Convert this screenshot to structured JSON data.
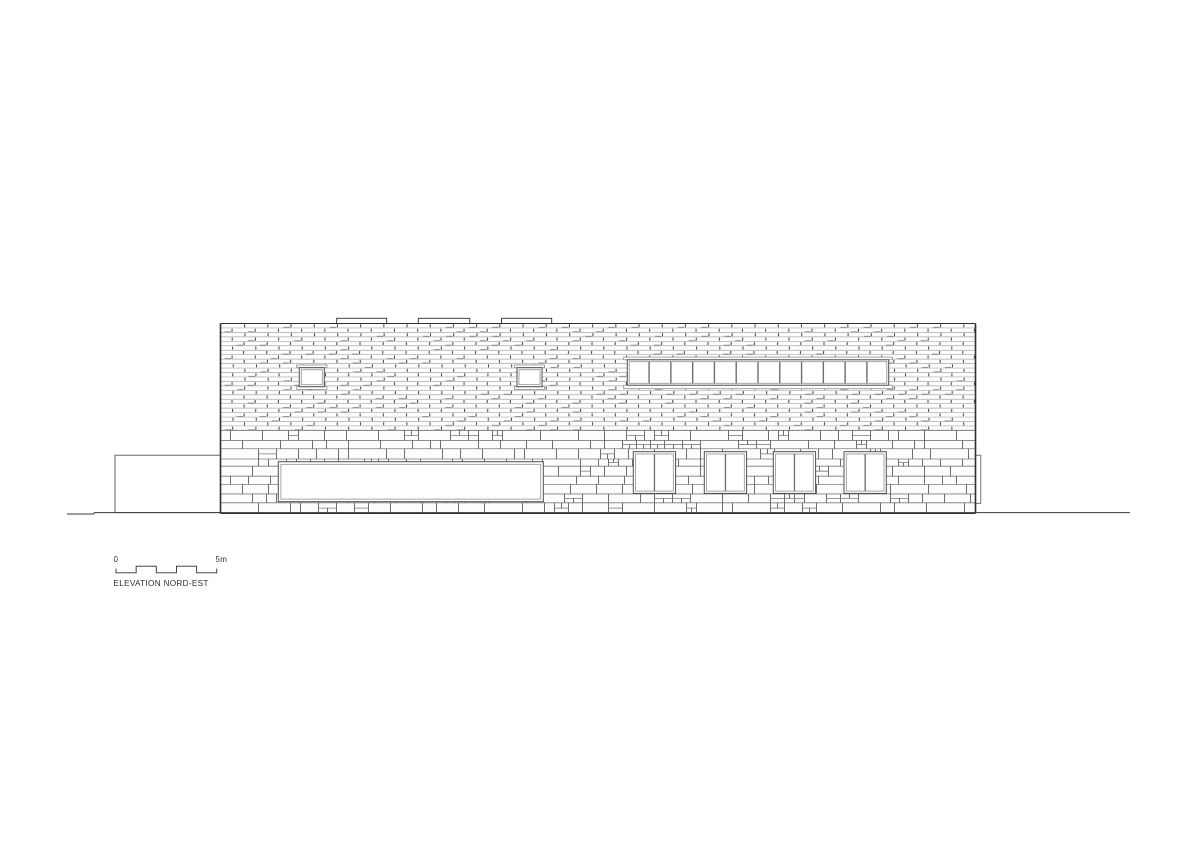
{
  "title": "ELEVATION NORD-EST",
  "scale_bar": {
    "start_label": "0",
    "end_label": "5m",
    "x": 116.0,
    "y_top": 566.2,
    "y_bottom": 572.8,
    "segment_w": 20.15,
    "segments": 5,
    "end_tick_y": 568.6
  },
  "drawing": {
    "canvas": {
      "w": 1200,
      "h": 848
    },
    "colors": {
      "outline": "#2f2f2f",
      "frame": "#4f4f4f",
      "frame_inner": "#909090",
      "mullion": "#6e6e6e",
      "brick_line": "#a9a9a9",
      "brick_tick": "#4d4d4d",
      "brick_accent": "#8a8a8a",
      "ashlar_line": "#7d7d7d",
      "ashlar_joint": "#5f5f5f",
      "band_stroke": "#8f8f8f",
      "facade_fill": "#fdfdfd",
      "white": "#ffffff",
      "ground": "#3a3a3a"
    },
    "building": {
      "x1": 220.5,
      "y1": 323.5,
      "x2": 975.5,
      "y2": 513.4
    },
    "brick": {
      "y_bottom": 430.4,
      "row_h": 4.4542,
      "brick_w": 23.2
    },
    "ashlar": {
      "row_min": 7.0,
      "row_max": 10.4,
      "block_widths": [
        10,
        14,
        18,
        22,
        26,
        32,
        38
      ]
    },
    "upstands": [
      {
        "x": 336.7,
        "w": 50.0,
        "h": 5.2
      },
      {
        "x": 418.3,
        "w": 51.5,
        "h": 5.2
      },
      {
        "x": 501.5,
        "w": 50.2,
        "h": 5.2
      }
    ],
    "small_windows": {
      "xs": [
        299.3,
        517.0
      ],
      "y": 367.7,
      "w": 25.0,
      "h": 19.0,
      "band_ext": 2.6,
      "lintel_h": 2.7,
      "sill_h": 2.7,
      "inset": 2.0
    },
    "ribbon_window": {
      "x": 627.3,
      "y": 359.8,
      "w": 261.4,
      "h": 25.4,
      "panes": 12,
      "band_ext": 3.6,
      "lintel_h": 2.7,
      "sill_h": 3.5,
      "inset": 1.9
    },
    "large_opening": {
      "x": 278.3,
      "y": 461.7,
      "w": 265.0,
      "h": 40.0,
      "inset": 2.6
    },
    "lower_windows": {
      "xs": [
        633.3,
        704.3,
        773.3,
        844.0
      ],
      "y": 451.7,
      "w": 42.3,
      "h": 41.7,
      "inset": 2.3
    },
    "annex": {
      "x": 115.0,
      "y": 455.2,
      "x2": 221.5,
      "y2": 512.6
    },
    "pilaster": {
      "x": 975.5,
      "y": 455.2,
      "w": 5.3,
      "h": 48.1
    },
    "ground": {
      "y": 512.6,
      "x1": 94.0,
      "x2": 1130.0,
      "step_x1": 67.0,
      "step_y": 514.0
    }
  }
}
